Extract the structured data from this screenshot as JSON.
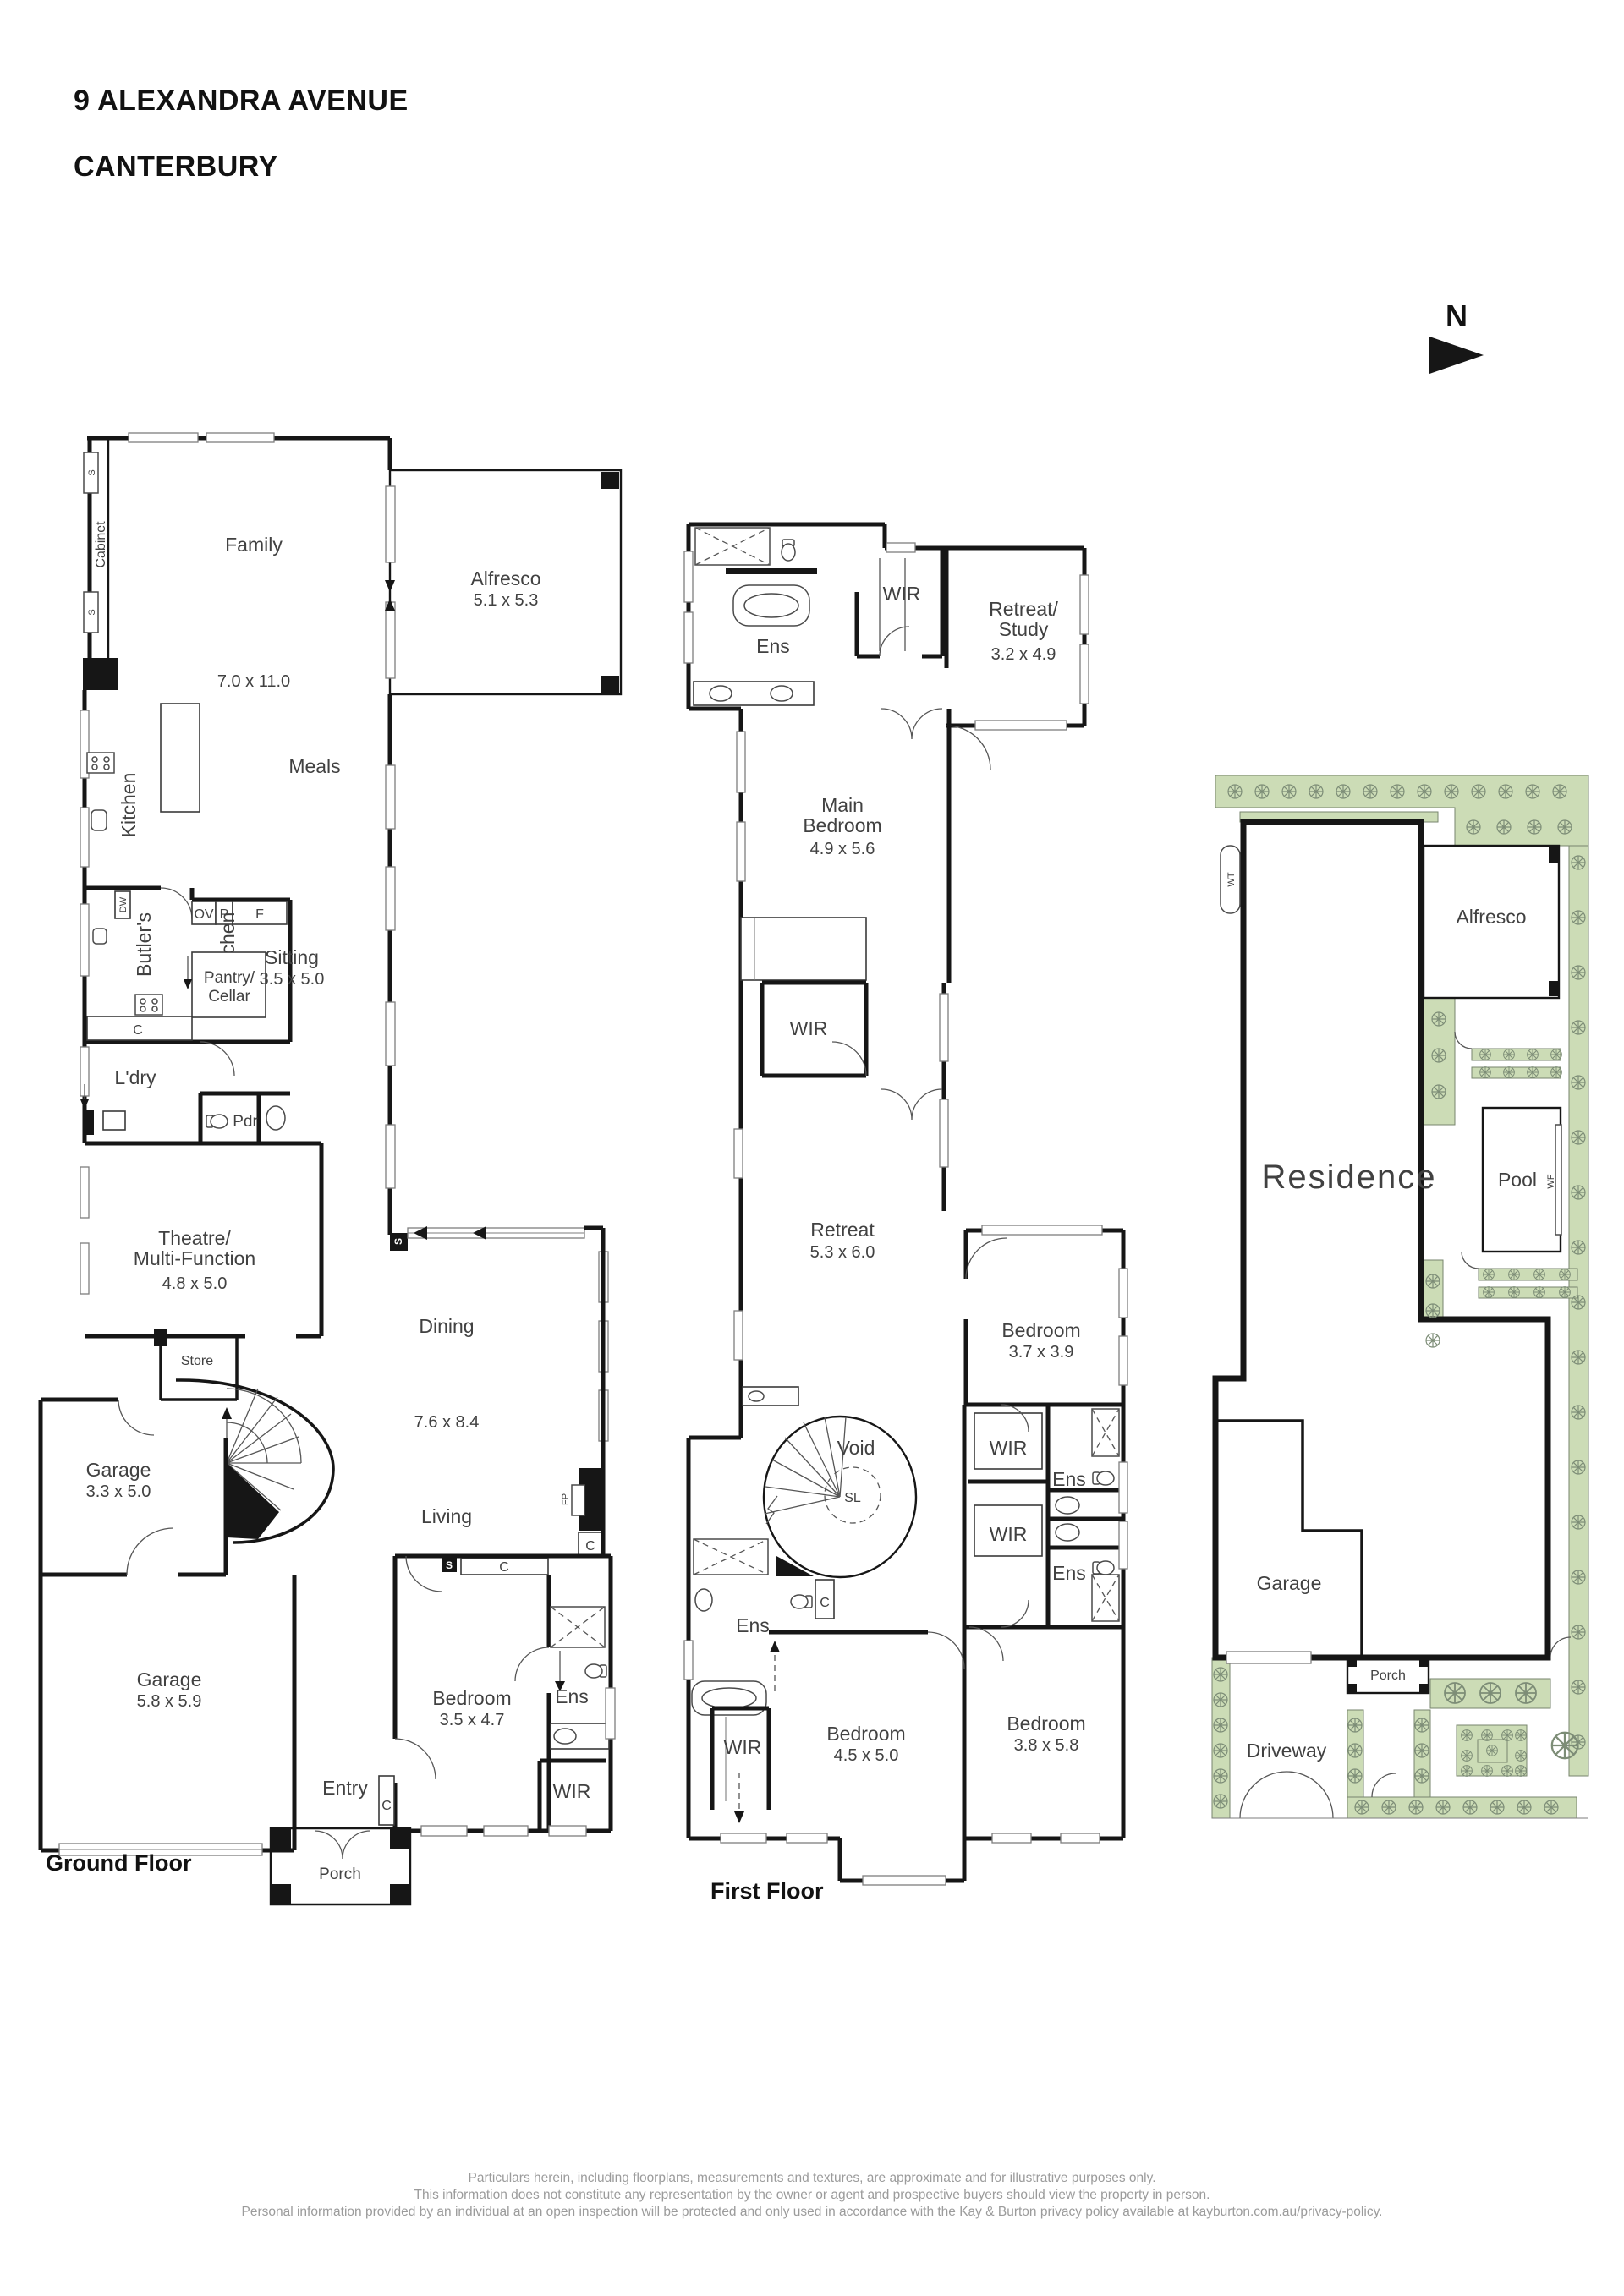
{
  "title": {
    "line1": "9 ALEXANDRA AVENUE",
    "line2": "CANTERBURY"
  },
  "north": {
    "label": "N"
  },
  "gf": {
    "caption": "Ground Floor",
    "family": "Family",
    "family_dim": "7.0 x 11.0",
    "alfresco": "Alfresco",
    "alfresco_dim": "5.1 x 5.3",
    "kitchen": "Kitchen",
    "meals": "Meals",
    "cabinet": "Cabinet",
    "butlers1": "Butler's",
    "butlers2": "Kitchen",
    "pantry1": "Pantry/",
    "pantry2": "Cellar",
    "sitting": "Sitting",
    "sitting_dim": "3.5 x 5.0",
    "ldry": "L'dry",
    "pdr": "Pdr",
    "theatre1": "Theatre/",
    "theatre2": "Multi-Function",
    "theatre_dim": "4.8 x 5.0",
    "store": "Store",
    "garage1": "Garage",
    "garage1_dim": "3.3 x 5.0",
    "garage2": "Garage",
    "garage2_dim": "5.8 x 5.9",
    "dining": "Dining",
    "dining_dim": "7.6 x 8.4",
    "living": "Living",
    "bedroom": "Bedroom",
    "bedroom_dim": "3.5 x 4.7",
    "ens": "Ens",
    "wir": "WIR",
    "entry": "Entry",
    "porch": "Porch",
    "ov": "OV",
    "p": "P",
    "f": "F",
    "c": "C",
    "s": "S",
    "dw": "DW",
    "fp": "FP"
  },
  "ff": {
    "caption": "First Floor",
    "ens": "Ens",
    "wir": "WIR",
    "c": "C",
    "retreat_study1": "Retreat/",
    "retreat_study2": "Study",
    "retreat_study_dim": "3.2 x 4.9",
    "main1": "Main",
    "main2": "Bedroom",
    "main_dim": "4.9 x 5.6",
    "retreat": "Retreat",
    "retreat_dim": "5.3 x 6.0",
    "bedroom2": "Bedroom",
    "bedroom2_dim": "3.7 x 3.9",
    "bedroom3": "Bedroom",
    "bedroom3_dim": "4.5 x 5.0",
    "bedroom4": "Bedroom",
    "bedroom4_dim": "3.8 x 5.8",
    "void": "Void",
    "sl": "SL"
  },
  "site": {
    "residence": "Residence",
    "alfresco": "Alfresco",
    "pool": "Pool",
    "garage": "Garage",
    "porch": "Porch",
    "driveway": "Driveway",
    "wt": "WT",
    "wf": "WF"
  },
  "footer": {
    "line1": "Particulars herein, including floorplans, measurements and textures, are approximate and for illustrative purposes only.",
    "line2": "This information does not constitute any representation by the owner or agent and prospective buyers should view the property in person.",
    "line3": "Personal information provided by an individual at an open inspection will be protected and only used in accordance with the Kay & Burton privacy policy available at kayburton.com.au/privacy-policy."
  },
  "colors": {
    "ink": "#161616",
    "landscape_green": "#ccdcb6",
    "footer_gray": "#9b9b9b"
  }
}
